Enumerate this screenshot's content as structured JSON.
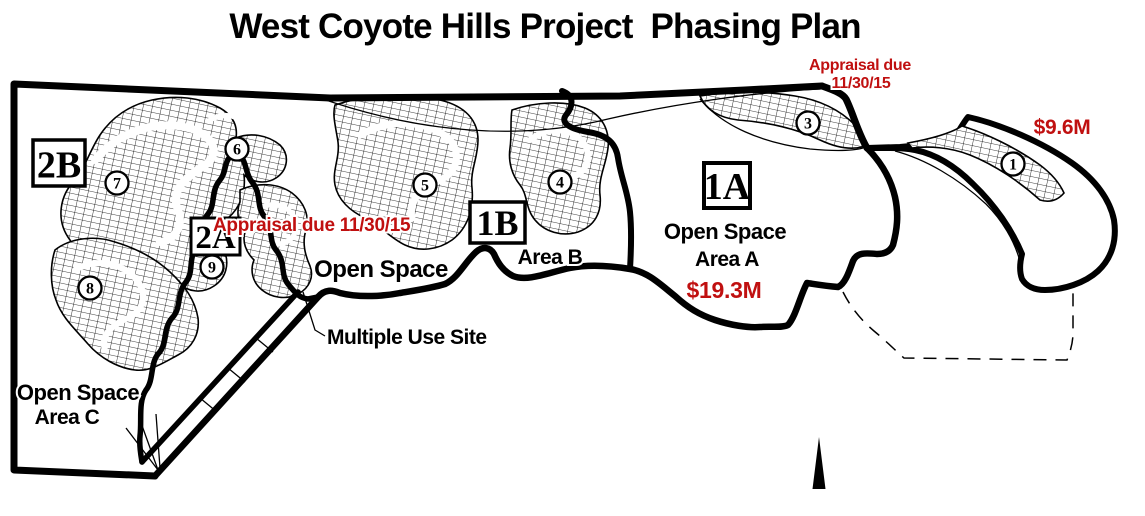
{
  "title": "West Coyote Hills Project  Phasing Plan",
  "colors": {
    "annotation_red": "#C01010",
    "map_black": "#000000"
  },
  "phases": {
    "p2b": "2B",
    "p2a": "2A",
    "p1b": "1B",
    "p1a": "1A"
  },
  "parcels": {
    "n1": "1",
    "n3": "3",
    "n4": "4",
    "n5": "5",
    "n6": "6",
    "n7": "7",
    "n8": "8",
    "n9": "9"
  },
  "labels": {
    "open_space_mid": "Open Space",
    "area_b": "Area B",
    "open_space_a_line1": "Open Space",
    "open_space_a_line2": "Area A",
    "open_space_c_line1": "Open Space",
    "open_space_c_line2": "Area C",
    "multiple_use_site": "Multiple Use Site"
  },
  "annotations": {
    "appraisal_left": "Appraisal due 11/30/15",
    "appraisal_right_line1": "Appraisal due",
    "appraisal_right_line2": "11/30/15",
    "amount_area_a": "$19.3M",
    "amount_right": "$9.6M"
  }
}
